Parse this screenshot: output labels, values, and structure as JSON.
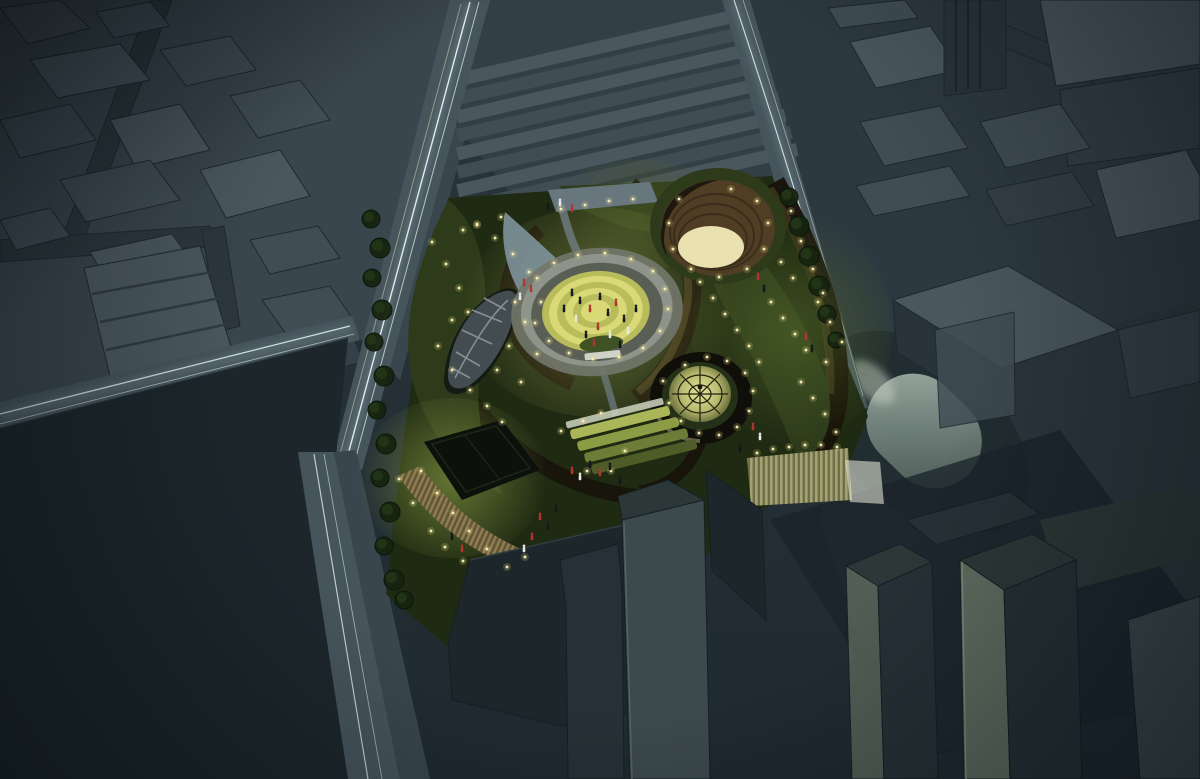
{
  "meta": {
    "description": "Night-time aerial architectural rendering of an illuminated landscaped park block (green roofscape with circular lit plaza, sunken amphitheatre, glass dome pavilion, leaf-shaped skylight, terraced lawns) surrounded by dark untextured massing-model city blocks, light-trail streaked roads and a pale oval plaza.",
    "scene_type": "3d-massing-render-night"
  },
  "palette": {
    "bg": "#222d33",
    "groundNW": "#3a464d",
    "groundN": "#333f46",
    "groundNE": "#2d3940",
    "groundE": "#2b363c",
    "bTop": "#414d55",
    "bTopL": "#4b575f",
    "bSide": "#29343a",
    "bDark": "#343f47",
    "road": "#46545c",
    "roadDark": "#2c373d",
    "sidewalk": "#39464d",
    "trailCore": "#e9f4f2",
    "trailSoft": "#a9c3c6",
    "parkBase": "#1f2a12",
    "lawn": "#2d3b1a",
    "lawnLit": "#47571f",
    "pathDark": "#17120a",
    "pathWarm": "#584a28",
    "pathLite": "#6f7d84",
    "plazaRing": "#72776b",
    "plazaRingLit": "#8f948a",
    "plazaY1": "#d9d977",
    "plazaY2": "#b9bc5a",
    "plazaY3": "#caCD67",
    "plazaGrass": "#3f5223",
    "bowl": "#4f3d24",
    "bowlDark": "#2e2414",
    "stageFloor": "#e9e2b0",
    "domeRing": "#0f0e09",
    "domeRib": "#23210f",
    "stripeL": "#a3a371",
    "stripeD": "#6e6e4a",
    "stripeWarmL": "#8f7f50",
    "stripeWarmD": "#625538",
    "ovalDark": "#222d31",
    "massDark": "#1c262b",
    "towerLight": "#5e6c5f",
    "towerMid": "#3d4a4d",
    "towerTop": "#2c3837",
    "towerDark": "#253136",
    "rampPale": "#7e929b",
    "entrance": "#68767e",
    "courtDark": "#0c110b",
    "tree": "#16240f",
    "treeEdge": "#0b1408",
    "treeHi": "#243a18",
    "light": "#f7efc0",
    "lightGlow": "#e8d87a",
    "personDark": "#14181c",
    "personRed": "#b23430",
    "personWhite": "#e8eae8"
  },
  "scene": {
    "lights": [
      [
        432,
        242
      ],
      [
        446,
        264
      ],
      [
        459,
        288
      ],
      [
        468,
        312
      ],
      [
        452,
        320
      ],
      [
        438,
        346
      ],
      [
        452,
        370
      ],
      [
        470,
        390
      ],
      [
        487,
        406
      ],
      [
        502,
        422
      ],
      [
        515,
        302
      ],
      [
        525,
        322
      ],
      [
        509,
        346
      ],
      [
        497,
        370
      ],
      [
        521,
        382
      ],
      [
        537,
        354
      ],
      [
        541,
        302
      ],
      [
        529,
        272
      ],
      [
        513,
        254
      ],
      [
        495,
        238
      ],
      [
        477,
        224
      ],
      [
        463,
        230
      ],
      [
        537,
        278
      ],
      [
        554,
        263
      ],
      [
        578,
        255
      ],
      [
        605,
        253
      ],
      [
        631,
        259
      ],
      [
        653,
        271
      ],
      [
        665,
        289
      ],
      [
        668,
        309
      ],
      [
        660,
        331
      ],
      [
        643,
        348
      ],
      [
        619,
        357
      ],
      [
        593,
        359
      ],
      [
        569,
        353
      ],
      [
        549,
        341
      ],
      [
        535,
        323
      ],
      [
        700,
        282
      ],
      [
        713,
        298
      ],
      [
        725,
        314
      ],
      [
        737,
        330
      ],
      [
        749,
        346
      ],
      [
        759,
        362
      ],
      [
        771,
        302
      ],
      [
        783,
        318
      ],
      [
        795,
        334
      ],
      [
        806,
        350
      ],
      [
        781,
        262
      ],
      [
        793,
        278
      ],
      [
        818,
        302
      ],
      [
        830,
        322
      ],
      [
        842,
        342
      ],
      [
        826,
        362
      ],
      [
        801,
        382
      ],
      [
        813,
        398
      ],
      [
        825,
        414
      ],
      [
        836,
        432
      ],
      [
        679,
        199
      ],
      [
        669,
        223
      ],
      [
        673,
        249
      ],
      [
        691,
        269
      ],
      [
        719,
        277
      ],
      [
        747,
        269
      ],
      [
        764,
        249
      ],
      [
        768,
        223
      ],
      [
        757,
        201
      ],
      [
        731,
        189
      ],
      [
        663,
        381
      ],
      [
        669,
        403
      ],
      [
        681,
        421
      ],
      [
        699,
        433
      ],
      [
        719,
        435
      ],
      [
        737,
        427
      ],
      [
        749,
        411
      ],
      [
        753,
        391
      ],
      [
        745,
        373
      ],
      [
        727,
        361
      ],
      [
        707,
        357
      ],
      [
        685,
        365
      ],
      [
        583,
        421
      ],
      [
        601,
        413
      ],
      [
        561,
        431
      ],
      [
        625,
        451
      ],
      [
        587,
        471
      ],
      [
        611,
        471
      ],
      [
        421,
        471
      ],
      [
        437,
        493
      ],
      [
        453,
        513
      ],
      [
        469,
        531
      ],
      [
        487,
        549
      ],
      [
        431,
        531
      ],
      [
        413,
        503
      ],
      [
        399,
        479
      ],
      [
        445,
        547
      ],
      [
        463,
        561
      ],
      [
        507,
        567
      ],
      [
        525,
        557
      ],
      [
        561,
        209
      ],
      [
        585,
        205
      ],
      [
        609,
        201
      ],
      [
        633,
        199
      ],
      [
        501,
        217
      ],
      [
        477,
        225
      ],
      [
        791,
        211
      ],
      [
        801,
        241
      ],
      [
        813,
        269
      ],
      [
        823,
        293
      ],
      [
        757,
        453
      ],
      [
        773,
        449
      ],
      [
        789,
        447
      ],
      [
        805,
        445
      ],
      [
        821,
        445
      ],
      [
        837,
        447
      ]
    ],
    "trees": [
      [
        371,
        219,
        9
      ],
      [
        380,
        248,
        10
      ],
      [
        372,
        278,
        9
      ],
      [
        382,
        310,
        10
      ],
      [
        374,
        342,
        9
      ],
      [
        384,
        376,
        10
      ],
      [
        377,
        410,
        9
      ],
      [
        386,
        444,
        10
      ],
      [
        380,
        478,
        9
      ],
      [
        390,
        512,
        10
      ],
      [
        384,
        546,
        9
      ],
      [
        394,
        580,
        10
      ],
      [
        404,
        600,
        9
      ],
      [
        789,
        197,
        9
      ],
      [
        799,
        226,
        10
      ],
      [
        809,
        256,
        10
      ],
      [
        819,
        286,
        10
      ],
      [
        827,
        314,
        9
      ],
      [
        836,
        340,
        8
      ]
    ],
    "people": [
      [
        572,
        296,
        "d"
      ],
      [
        580,
        304,
        "d"
      ],
      [
        590,
        312,
        "r"
      ],
      [
        600,
        300,
        "d"
      ],
      [
        608,
        316,
        "d"
      ],
      [
        616,
        306,
        "r"
      ],
      [
        624,
        322,
        "d"
      ],
      [
        598,
        330,
        "r"
      ],
      [
        586,
        338,
        "d"
      ],
      [
        610,
        338,
        "w"
      ],
      [
        628,
        334,
        "w"
      ],
      [
        576,
        322,
        "w"
      ],
      [
        594,
        346,
        "r"
      ],
      [
        620,
        348,
        "d"
      ],
      [
        636,
        312,
        "d"
      ],
      [
        564,
        312,
        "d"
      ],
      [
        524,
        286,
        "r"
      ],
      [
        531,
        292,
        "r"
      ],
      [
        520,
        300,
        "w"
      ],
      [
        560,
        206,
        "w"
      ],
      [
        572,
        212,
        "r"
      ],
      [
        548,
        210,
        "d"
      ],
      [
        758,
        280,
        "r"
      ],
      [
        764,
        292,
        "d"
      ],
      [
        806,
        340,
        "r"
      ],
      [
        812,
        352,
        "d"
      ],
      [
        746,
        418,
        "d"
      ],
      [
        753,
        430,
        "r"
      ],
      [
        760,
        440,
        "w"
      ],
      [
        740,
        452,
        "d"
      ],
      [
        590,
        468,
        "d"
      ],
      [
        600,
        476,
        "r"
      ],
      [
        610,
        470,
        "d"
      ],
      [
        580,
        480,
        "w"
      ],
      [
        620,
        484,
        "d"
      ],
      [
        572,
        474,
        "r"
      ],
      [
        540,
        520,
        "r"
      ],
      [
        548,
        530,
        "d"
      ],
      [
        532,
        540,
        "r"
      ],
      [
        524,
        552,
        "w"
      ],
      [
        556,
        512,
        "d"
      ],
      [
        452,
        540,
        "d"
      ],
      [
        462,
        552,
        "r"
      ]
    ]
  }
}
